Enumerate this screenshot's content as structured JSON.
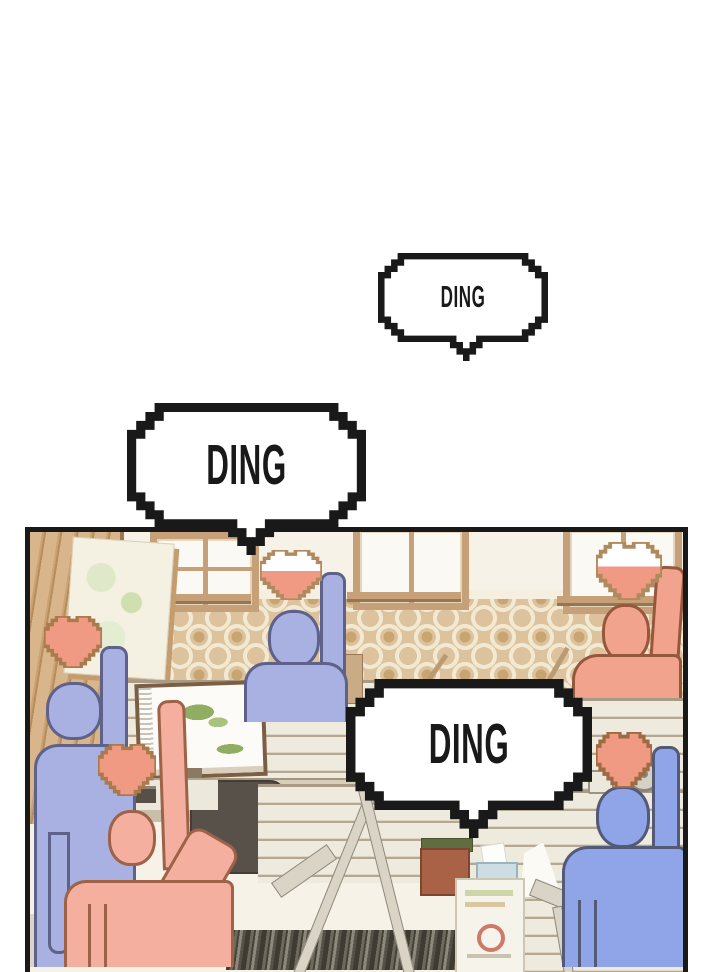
{
  "page": {
    "type": "webtoon-comic-panel"
  },
  "bubbles": [
    {
      "id": "bubble-1",
      "label": "DING"
    },
    {
      "id": "bubble-2",
      "label": "DING"
    },
    {
      "id": "bubble-3",
      "label": "DING"
    }
  ],
  "scene": {
    "setting": "office with cubicles, monitors and patterned wallpaper",
    "hearts": [
      {
        "owner": "left-blue-figure",
        "state": "filled"
      },
      {
        "owner": "left-pink-figure",
        "state": "filled"
      },
      {
        "owner": "center-blue-figure",
        "state": "half"
      },
      {
        "owner": "right-pink-figure",
        "state": "half"
      },
      {
        "owner": "right-blue-figure",
        "state": "filled"
      }
    ]
  },
  "palette": {
    "ink": "#191919",
    "white": "#ffffff",
    "wallCream": "#f7f2e8",
    "wpBase": "#dcc39e",
    "wpRing": "#f2e9d3",
    "wpDot": "#c8a470",
    "wood": "#d8b58b",
    "woodLine": "#b78d5e",
    "frame": "#c5a078",
    "frameLine": "#96764f",
    "pane": "#fbf9f3",
    "slat": "#eeeadd",
    "slatLine": "#b4a892",
    "deskTop": "#d8cebc",
    "deskFront": "#c9beaa",
    "bezel": "#7b5f45",
    "screen": "#fcfbf7",
    "mapGreen": "#8fae62",
    "chair": "#57514a",
    "blue1": "#a9b1e2",
    "blue1Line": "#5f6288",
    "blue2": "#8fa5e7",
    "blue2Line": "#525a78",
    "pink1": "#f4af9e",
    "pink1Line": "#9d6248",
    "pink2": "#f2a38e",
    "pink2Line": "#96573d",
    "heart": "#f09a84",
    "heartLine": "#a87a4e",
    "lamp": "#d9d4c6",
    "lampLine": "#8f8a7b",
    "posterBg": "#f6f3ea",
    "redAccent": "#c2503c",
    "boxRed": "#a96246",
    "boxGreen": "#5f6d40",
    "boxBlue": "#ccdde4",
    "clockFace": "#d6d1c5",
    "floorShadow": "#dbd5c9"
  }
}
